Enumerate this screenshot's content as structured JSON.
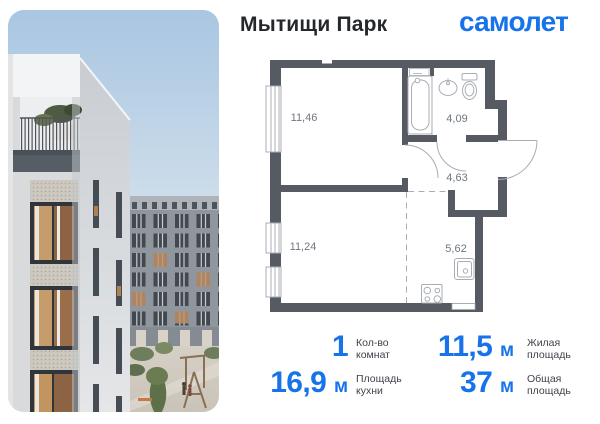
{
  "header": {
    "title": "Мытищи Парк",
    "brand": "самолет"
  },
  "floor_plan": {
    "rooms": [
      {
        "name": "living-room",
        "area": "11,46"
      },
      {
        "name": "bathroom",
        "area": "4,09"
      },
      {
        "name": "hallway",
        "area": "4,63"
      },
      {
        "name": "bedroom",
        "area": "11,24"
      },
      {
        "name": "kitchen",
        "area": "5,62"
      }
    ]
  },
  "stats": [
    {
      "value": "1",
      "unit": "",
      "label_line1": "Кол-во",
      "label_line2": "комнат"
    },
    {
      "value": "11,5",
      "unit": "м",
      "label_line1": "Жилая",
      "label_line2": "площадь"
    },
    {
      "value": "16,9",
      "unit": "м",
      "label_line1": "Площадь",
      "label_line2": "кухни"
    },
    {
      "value": "37",
      "unit": "м",
      "label_line1": "Общая",
      "label_line2": "площадь"
    }
  ],
  "colors": {
    "accent": "#1673EA",
    "wall": "#555A63",
    "plan_line": "#A8ADB5",
    "room_label": "#6F7680"
  }
}
